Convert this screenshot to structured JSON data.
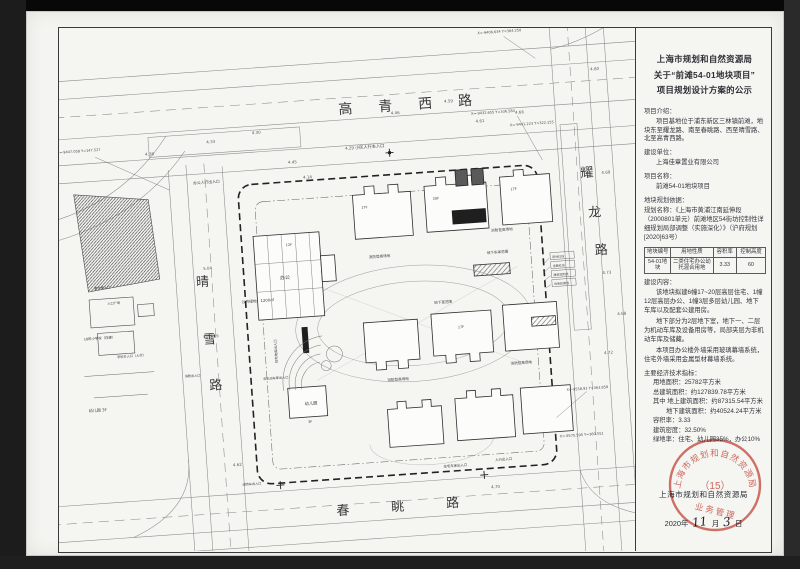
{
  "panel": {
    "title": [
      "上海市规划和自然资源局",
      "关于“前滩54-01地块项目”",
      "项目规划设计方案的公示"
    ],
    "intro_heading": "项目介绍：",
    "intro_text": "项目基地位于浦东新区三林镇前滩，地块东至耀龙路、南至春眺路、西至晴雪路、北至高青西路。",
    "developer_heading": "建设单位：",
    "developer": "上海佳章置业有限公司",
    "project_heading": "项目名称：",
    "project_name": "前滩54-01地块项目",
    "basis_heading": "地块规划依据：",
    "basis_text": "规划名称：《上海市黄浦江南延伸段（2000801单元）前滩地区54街坊控制性详细规划局部调整（实施深化）》（沪府规划[2020]63号）",
    "table": {
      "headers": [
        "地块编号",
        "用地性质",
        "容积率",
        "控制高度"
      ],
      "rows": [
        [
          "54-01地块",
          "二类住宅办公幼托混合用地",
          "3.33",
          "60"
        ]
      ]
    },
    "content_heading": "建设内容：",
    "content_p1": "该地块拟建6幢17~20层高层住宅、1幢12层高层办公、1幢3层多层幼儿园、地下车库以及配套公建用房。",
    "content_p2": "地下部分为2层地下室，地下一、二层为机动车库及设备用房等，局部夹层为非机动车库及储藏。",
    "content_p3": "本项目办公楼外墙采用玻璃幕墙系统，住宅外墙采用金属型材幕墙系统。",
    "econ_heading": "主要经济技术指标：",
    "econ_items": [
      "用地面积：25782平方米",
      "总建筑面积：约127839.78平方米",
      "其中 地上建筑面积：约87315.54平方米",
      "地下建筑面积：约40524.24平方米",
      "容积率：3.33",
      "建筑密度：32.50%",
      "绿地率：住宅、幼儿园35%，办公10%"
    ],
    "authority": "上海市规划和自然资源局",
    "date_prefix": "2020年",
    "date_month": "11",
    "date_month_suffix": "月",
    "date_day": "3",
    "date_day_suffix": "日",
    "stamp": {
      "arc_top": "上海市规划和自然资源局",
      "center": "（15）",
      "arc_bottom": "业务管理",
      "color": "#c8473a"
    }
  },
  "plan": {
    "roads": {
      "north": "高青西路",
      "east": "耀龙路",
      "west": "晴雪路",
      "south": "春眺路"
    },
    "labels": [
      {
        "t": "小区人行主入口"
      },
      {
        "t": "办公人行出入口"
      },
      {
        "t": "办公"
      },
      {
        "t": "公共绿地：1200㎡"
      },
      {
        "t": "消防登高场地"
      },
      {
        "t": "消防登高场地"
      },
      {
        "t": "消防登高场地"
      },
      {
        "t": "消防登高场地"
      },
      {
        "t": "地下车库范围"
      },
      {
        "t": "地下室范围"
      },
      {
        "t": "住宅地库出入口"
      },
      {
        "t": "非机动车库出入口"
      },
      {
        "t": "幼儿园 3F"
      },
      {
        "t": "18班小学校（在建）"
      },
      {
        "t": "学校主入口（人行）"
      },
      {
        "t": "入口广场"
      },
      {
        "t": "教学楼入口"
      },
      {
        "t": "住宅车库出入口"
      },
      {
        "t": "人行出入口"
      },
      {
        "t": "消防车出入口"
      },
      {
        "t": "X=-9406.634 Y=364.250"
      },
      {
        "t": "X=-9432.655 Y=336.584"
      },
      {
        "t": "X=-9441.223 Y=322.155"
      },
      {
        "t": "X=-9447.058 Y=147.527"
      },
      {
        "t": "X=-9558.91 Y=363.858"
      },
      {
        "t": "X=-9575.595 Y=360.551"
      },
      {
        "t": "4.38"
      },
      {
        "t": "4.33"
      },
      {
        "t": "4.30"
      },
      {
        "t": "4.29"
      },
      {
        "t": "4.45"
      },
      {
        "t": "4.14"
      },
      {
        "t": "4.46"
      },
      {
        "t": "4.59"
      },
      {
        "t": "4.61"
      },
      {
        "t": "4.66"
      },
      {
        "t": "4.80"
      },
      {
        "t": "4.69"
      },
      {
        "t": "4.73"
      },
      {
        "t": "4.72"
      },
      {
        "t": "4.68"
      },
      {
        "t": "4.62"
      },
      {
        "t": "5.04"
      },
      {
        "t": "5.15"
      },
      {
        "t": "4.70"
      },
      {
        "t": "5.80"
      },
      {
        "t": "用地红线"
      },
      {
        "t": "道路红线"
      },
      {
        "t": "建筑控制线"
      },
      {
        "t": "地库轮廓线"
      },
      {
        "t": "幼儿园"
      },
      {
        "t": "17F"
      },
      {
        "t": "20F"
      },
      {
        "t": "17F"
      },
      {
        "t": "12F"
      },
      {
        "t": "17F"
      },
      {
        "t": "3F"
      },
      {
        "t": "消防出入口"
      }
    ]
  }
}
